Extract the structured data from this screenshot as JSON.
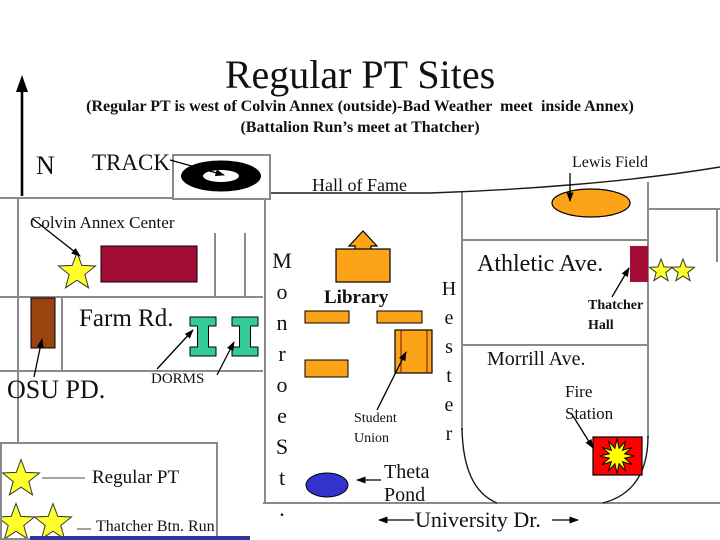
{
  "slide": {
    "title": "Regular PT Sites",
    "subtitle1": "(Regular PT is west of Colvin Annex (outside)-Bad Weather  meet  inside Annex)",
    "subtitle2": "(Battalion Run’s meet at Thatcher)"
  },
  "compass": {
    "north_label": "N"
  },
  "map": {
    "track": "TRACK",
    "hall_of_fame": "Hall of Fame",
    "lewis_field": "Lewis Field",
    "colvin_annex": "Colvin Annex Center",
    "farm_rd": "Farm Rd.",
    "osu_pd": "OSU PD.",
    "dorms": "DORMS",
    "monroe_st": "Monroe St.",
    "hester": "Hester",
    "library": "Library",
    "student_union": "Student\nUnion",
    "theta_pond": "Theta\nPond",
    "athletic_ave": "Athletic Ave.",
    "thatcher_hall": "Thatcher\nHall",
    "morrill_ave": "Morrill Ave.",
    "fire_station": "Fire\nStation",
    "university_dr": "University Dr."
  },
  "legend": {
    "regular_pt": "Regular PT",
    "thatcher_btn_run": "Thatcher Btn. Run"
  },
  "colors": {
    "building_maroon": "#A30C35",
    "building_brown": "#9A430E",
    "building_orange": "#FCA318",
    "dorm_teal": "#33CC99",
    "pond_blue": "#3333CC",
    "fire_red": "#FF0000",
    "star_yellow": "#FFFF2B",
    "road_gray": "#8A8A8A",
    "footer_blue": "#3333A0"
  }
}
